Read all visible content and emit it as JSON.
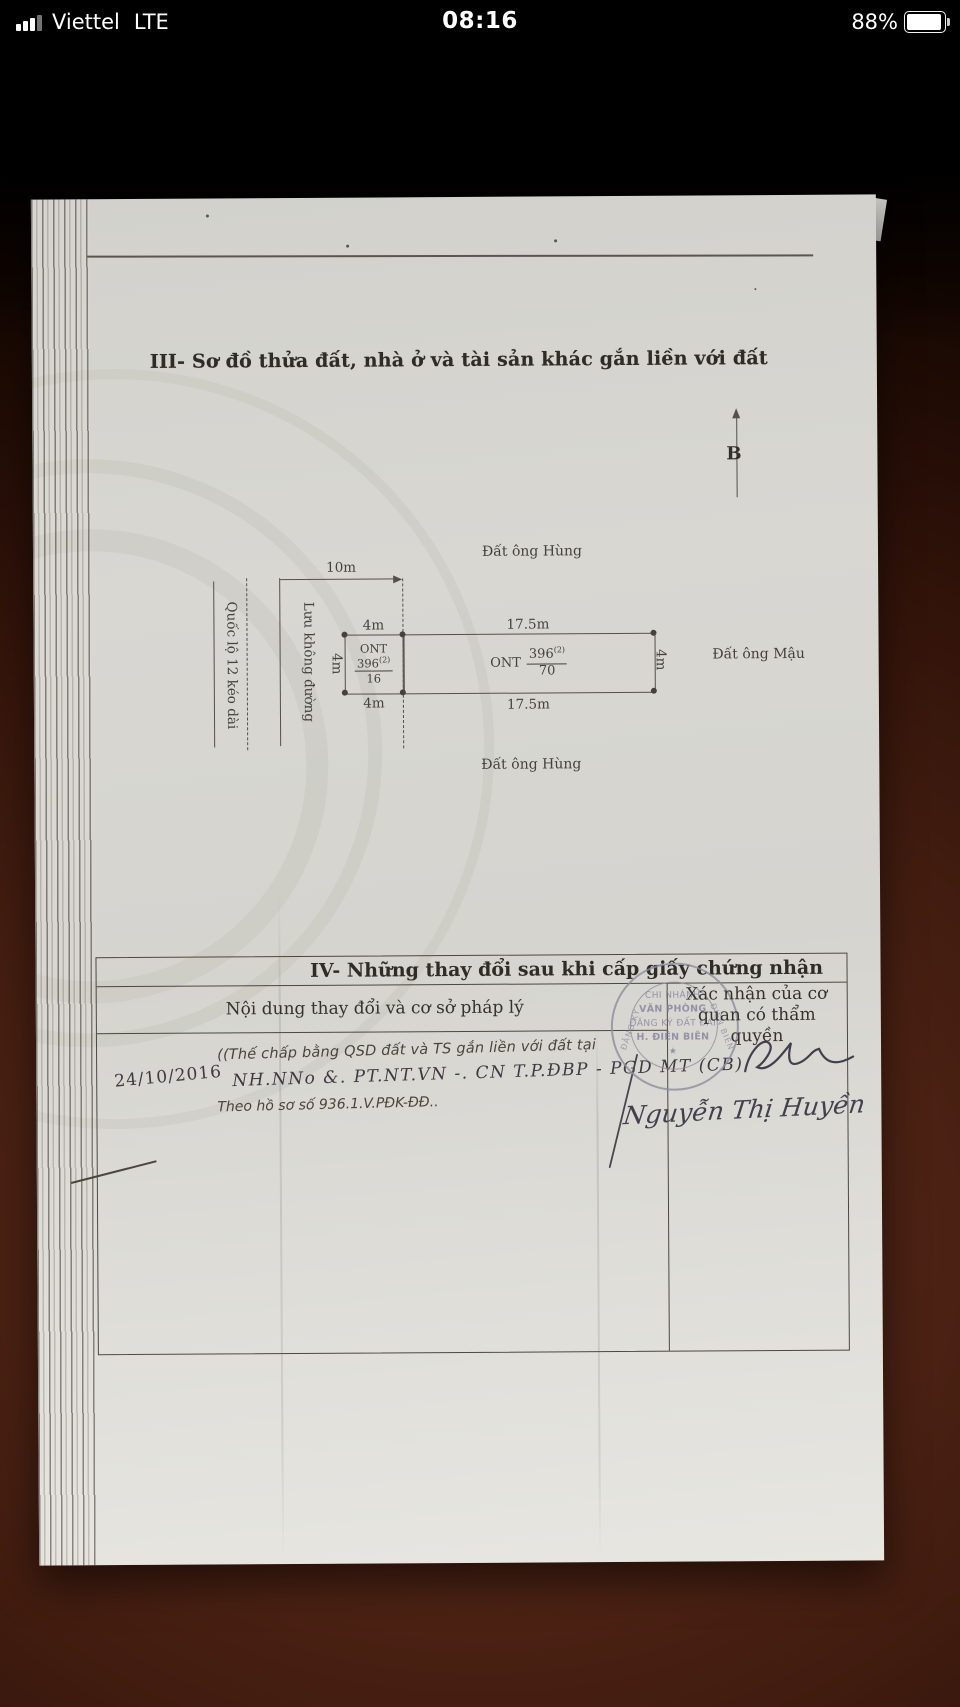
{
  "status_bar": {
    "carrier": "Viettel",
    "network": "LTE",
    "time": "08:16",
    "battery": "88%"
  },
  "page": {
    "section3_title": "III- Sơ đồ thửa đất, nhà ở và tài sản khác gắn liền với đất",
    "compass": "B",
    "diagram": {
      "top_neighbor": "Đất ông Hùng",
      "right_neighbor": "Đất ông Mậu",
      "bottom_neighbor": "Đất ông Hùng",
      "road": "Quốc lộ 12 kéo dài",
      "road_buffer": "Lưu không đường",
      "dim_road_width": "10m",
      "plot_small": {
        "w_top": "4m",
        "w_bottom": "4m",
        "h_left": "4m",
        "landuse": "ONT",
        "parcel": "396",
        "map_sup": "(2)",
        "area": "16"
      },
      "plot_large": {
        "w_top": "17.5m",
        "w_bottom": "17.5m",
        "h_right": "4m",
        "landuse": "ONT",
        "parcel": "396",
        "map_sup": "(2)",
        "area": "70"
      }
    },
    "section4": {
      "title": "IV- Những thay đổi sau khi cấp giấy chứng nhận",
      "col1_header": "Nội dung thay đổi và cơ sở pháp lý",
      "col2_header_line1": "Xác nhận của cơ",
      "col2_header_line2": "quan có thẩm quyền",
      "entry": {
        "date": "24/10/2016",
        "content1": "((Thế chấp bằng QSD đất và TS gắn liền với đất tại",
        "content2": "NH.NNo &. PT.NT.VN -. CN T.P.ĐBP - PGD MT (CB)",
        "content3": "Theo hồ sơ số 936.1.V.PĐK-ĐĐ..",
        "signer": "Nguyễn Thị Huyền"
      },
      "stamp": {
        "line1": "CHI NHÁNH",
        "line2": "VĂN PHÒNG",
        "line3": "ĐĂNG KÝ ĐẤT ĐAI",
        "line4": "H. ĐIỆN BIÊN",
        "star": "★",
        "arc_left": "ĐĂNG KÝ",
        "arc_right": "ĐIỆN BIÊN"
      }
    },
    "colors": {
      "paper": "#d8d7d2",
      "table_surface": "#43200f",
      "ink": "#3f3c36",
      "stamp": "#8f8c9e"
    }
  }
}
